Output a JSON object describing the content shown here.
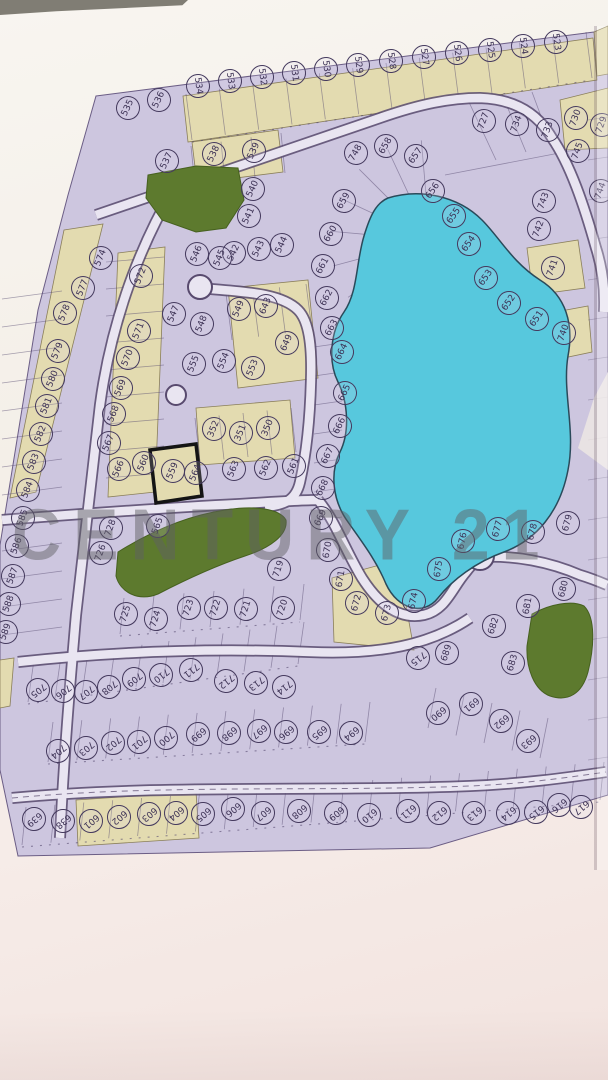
{
  "watermark": {
    "text": "CENTURY 21"
  },
  "map": {
    "type": "subdivision-plat",
    "highlighted_lot": "559",
    "colors": {
      "parcel_fill": "#cdc6df",
      "road_fill": "#e9e5f1",
      "road_edge": "#584a6e",
      "lake": "#57c8dd",
      "park": "#5d7a2e",
      "beige": "#e3dbb0",
      "ink": "#3c3154",
      "highlight_border": "#141414"
    },
    "lots": [
      [
        "535",
        127,
        107,
        -65
      ],
      [
        "536",
        158,
        99,
        -65
      ],
      [
        "537",
        166,
        160,
        -65
      ],
      [
        "538",
        213,
        153,
        -65
      ],
      [
        "539",
        253,
        150,
        -65
      ],
      [
        "540",
        252,
        188,
        -65
      ],
      [
        "541",
        248,
        215,
        -65
      ],
      [
        "542",
        233,
        252,
        -65
      ],
      [
        "543",
        258,
        248,
        -65
      ],
      [
        "544",
        281,
        244,
        -65
      ],
      [
        "545",
        219,
        257,
        -68
      ],
      [
        "546",
        196,
        253,
        -68
      ],
      [
        "534",
        197,
        85,
        82
      ],
      [
        "533",
        229,
        80,
        82
      ],
      [
        "532",
        261,
        76,
        82
      ],
      [
        "531",
        293,
        72,
        82
      ],
      [
        "530",
        325,
        68,
        82
      ],
      [
        "529",
        357,
        64,
        82
      ],
      [
        "528",
        390,
        60,
        82
      ],
      [
        "527",
        423,
        56,
        82
      ],
      [
        "526",
        456,
        52,
        82
      ],
      [
        "525",
        489,
        49,
        82
      ],
      [
        "524",
        522,
        45,
        82
      ],
      [
        "523",
        555,
        41,
        82
      ],
      [
        "730",
        575,
        117,
        -70
      ],
      [
        "729",
        601,
        124,
        -70
      ],
      [
        "727",
        483,
        120,
        -70
      ],
      [
        "734",
        516,
        123,
        -70
      ],
      [
        "733",
        547,
        129,
        -70
      ],
      [
        "745",
        577,
        150,
        -70
      ],
      [
        "744",
        600,
        190,
        -70
      ],
      [
        "743",
        543,
        200,
        -70
      ],
      [
        "742",
        538,
        228,
        -70
      ],
      [
        "741",
        552,
        267,
        -70
      ],
      [
        "740",
        563,
        332,
        -70
      ],
      [
        "748",
        355,
        152,
        -60
      ],
      [
        "658",
        385,
        145,
        -60
      ],
      [
        "657",
        415,
        155,
        -55
      ],
      [
        "656",
        432,
        190,
        -55
      ],
      [
        "655",
        453,
        215,
        -55
      ],
      [
        "654",
        468,
        243,
        -55
      ],
      [
        "653",
        485,
        277,
        -55
      ],
      [
        "652",
        508,
        302,
        -55
      ],
      [
        "651",
        536,
        318,
        -55
      ],
      [
        "659",
        343,
        200,
        -60
      ],
      [
        "660",
        330,
        233,
        -60
      ],
      [
        "661",
        322,
        265,
        -62
      ],
      [
        "662",
        326,
        297,
        -62
      ],
      [
        "663",
        331,
        327,
        -62
      ],
      [
        "664",
        341,
        351,
        -64
      ],
      [
        "665",
        344,
        392,
        -64
      ],
      [
        "666",
        339,
        425,
        -64
      ],
      [
        "667",
        327,
        455,
        -64
      ],
      [
        "668",
        322,
        487,
        -64
      ],
      [
        "669",
        320,
        517,
        -66
      ],
      [
        "670",
        327,
        549,
        -80
      ],
      [
        "671",
        340,
        578,
        -80
      ],
      [
        "547",
        173,
        313,
        -68
      ],
      [
        "548",
        201,
        323,
        -68
      ],
      [
        "549",
        238,
        308,
        -68
      ],
      [
        "643",
        265,
        305,
        -68
      ],
      [
        "649",
        286,
        342,
        -66
      ],
      [
        "555",
        193,
        363,
        -68
      ],
      [
        "554",
        223,
        360,
        -68
      ],
      [
        "553",
        252,
        367,
        -68
      ],
      [
        "352",
        213,
        428,
        -68
      ],
      [
        "351",
        240,
        432,
        -68
      ],
      [
        "350",
        267,
        427,
        -68
      ],
      [
        "560",
        143,
        462,
        -68
      ],
      [
        "559",
        172,
        470,
        -68
      ],
      [
        "564",
        195,
        472,
        -68
      ],
      [
        "563",
        233,
        468,
        -68
      ],
      [
        "562",
        265,
        467,
        -68
      ],
      [
        "561",
        293,
        465,
        -68
      ],
      [
        "565",
        157,
        525,
        -70
      ],
      [
        "574",
        100,
        257,
        -68
      ],
      [
        "577",
        82,
        287,
        -68
      ],
      [
        "578",
        64,
        312,
        -68
      ],
      [
        "579",
        57,
        350,
        -68
      ],
      [
        "580",
        52,
        378,
        -68
      ],
      [
        "581",
        46,
        405,
        -68
      ],
      [
        "582",
        40,
        433,
        -68
      ],
      [
        "583",
        33,
        461,
        -68
      ],
      [
        "584",
        27,
        489,
        -68
      ],
      [
        "585",
        22,
        517,
        -70
      ],
      [
        "586",
        16,
        545,
        -70
      ],
      [
        "587",
        12,
        575,
        -70
      ],
      [
        "588",
        8,
        603,
        -70
      ],
      [
        "589",
        5,
        631,
        -70
      ],
      [
        "572",
        140,
        275,
        -68
      ],
      [
        "571",
        138,
        330,
        -68
      ],
      [
        "570",
        127,
        357,
        -68
      ],
      [
        "569",
        120,
        387,
        -68
      ],
      [
        "568",
        113,
        413,
        -68
      ],
      [
        "567",
        108,
        442,
        -68
      ],
      [
        "566",
        118,
        468,
        -68
      ],
      [
        "728",
        110,
        527,
        -70
      ],
      [
        "726",
        100,
        552,
        -70
      ],
      [
        "725",
        125,
        613,
        -72
      ],
      [
        "724",
        155,
        618,
        -72
      ],
      [
        "723",
        188,
        607,
        -72
      ],
      [
        "722",
        215,
        607,
        -72
      ],
      [
        "721",
        245,
        608,
        -72
      ],
      [
        "720",
        282,
        607,
        -72
      ],
      [
        "719",
        278,
        568,
        -72
      ],
      [
        "672",
        356,
        602,
        -75
      ],
      [
        "673",
        386,
        612,
        -75
      ],
      [
        "674",
        413,
        600,
        -78
      ],
      [
        "675",
        438,
        568,
        -82
      ],
      [
        "676",
        462,
        540,
        -78
      ],
      [
        "677",
        497,
        528,
        -75
      ],
      [
        "678",
        532,
        531,
        -75
      ],
      [
        "679",
        567,
        522,
        -75
      ],
      [
        "680",
        563,
        588,
        -76
      ],
      [
        "681",
        527,
        605,
        -80
      ],
      [
        "682",
        493,
        625,
        -72
      ],
      [
        "683",
        512,
        662,
        -74
      ],
      [
        "689",
        446,
        652,
        -72
      ],
      [
        "715",
        417,
        657,
        142
      ],
      [
        "705",
        37,
        689,
        142
      ],
      [
        "706",
        62,
        690,
        142
      ],
      [
        "707",
        85,
        691,
        142
      ],
      [
        "708",
        108,
        686,
        142
      ],
      [
        "709",
        133,
        678,
        142
      ],
      [
        "710",
        160,
        674,
        142
      ],
      [
        "711",
        190,
        669,
        142
      ],
      [
        "712",
        225,
        680,
        142
      ],
      [
        "713",
        255,
        682,
        142
      ],
      [
        "714",
        283,
        686,
        142
      ],
      [
        "704",
        57,
        750,
        140
      ],
      [
        "703",
        85,
        747,
        140
      ],
      [
        "702",
        112,
        742,
        140
      ],
      [
        "701",
        138,
        741,
        140
      ],
      [
        "700",
        165,
        737,
        140
      ],
      [
        "699",
        197,
        733,
        140
      ],
      [
        "698",
        228,
        732,
        140
      ],
      [
        "697",
        258,
        730,
        140
      ],
      [
        "696",
        285,
        731,
        140
      ],
      [
        "695",
        318,
        731,
        140
      ],
      [
        "694",
        350,
        732,
        140
      ],
      [
        "690",
        437,
        712,
        140
      ],
      [
        "691",
        470,
        703,
        140
      ],
      [
        "692",
        500,
        720,
        140
      ],
      [
        "693",
        527,
        740,
        140
      ],
      [
        "639",
        33,
        818,
        140
      ],
      [
        "638",
        62,
        820,
        140
      ],
      [
        "601",
        90,
        820,
        140
      ],
      [
        "602",
        118,
        816,
        140
      ],
      [
        "603",
        148,
        813,
        140
      ],
      [
        "604",
        175,
        812,
        140
      ],
      [
        "605",
        202,
        813,
        140
      ],
      [
        "606",
        232,
        808,
        140
      ],
      [
        "607",
        262,
        812,
        140
      ],
      [
        "608",
        298,
        810,
        140
      ],
      [
        "609",
        335,
        812,
        140
      ],
      [
        "610",
        368,
        814,
        140
      ],
      [
        "611",
        407,
        810,
        140
      ],
      [
        "612",
        438,
        812,
        140
      ],
      [
        "613",
        473,
        812,
        140
      ],
      [
        "614",
        507,
        812,
        140
      ],
      [
        "615",
        535,
        811,
        140
      ],
      [
        "616",
        558,
        804,
        140
      ],
      [
        "617",
        580,
        806,
        140
      ]
    ]
  }
}
